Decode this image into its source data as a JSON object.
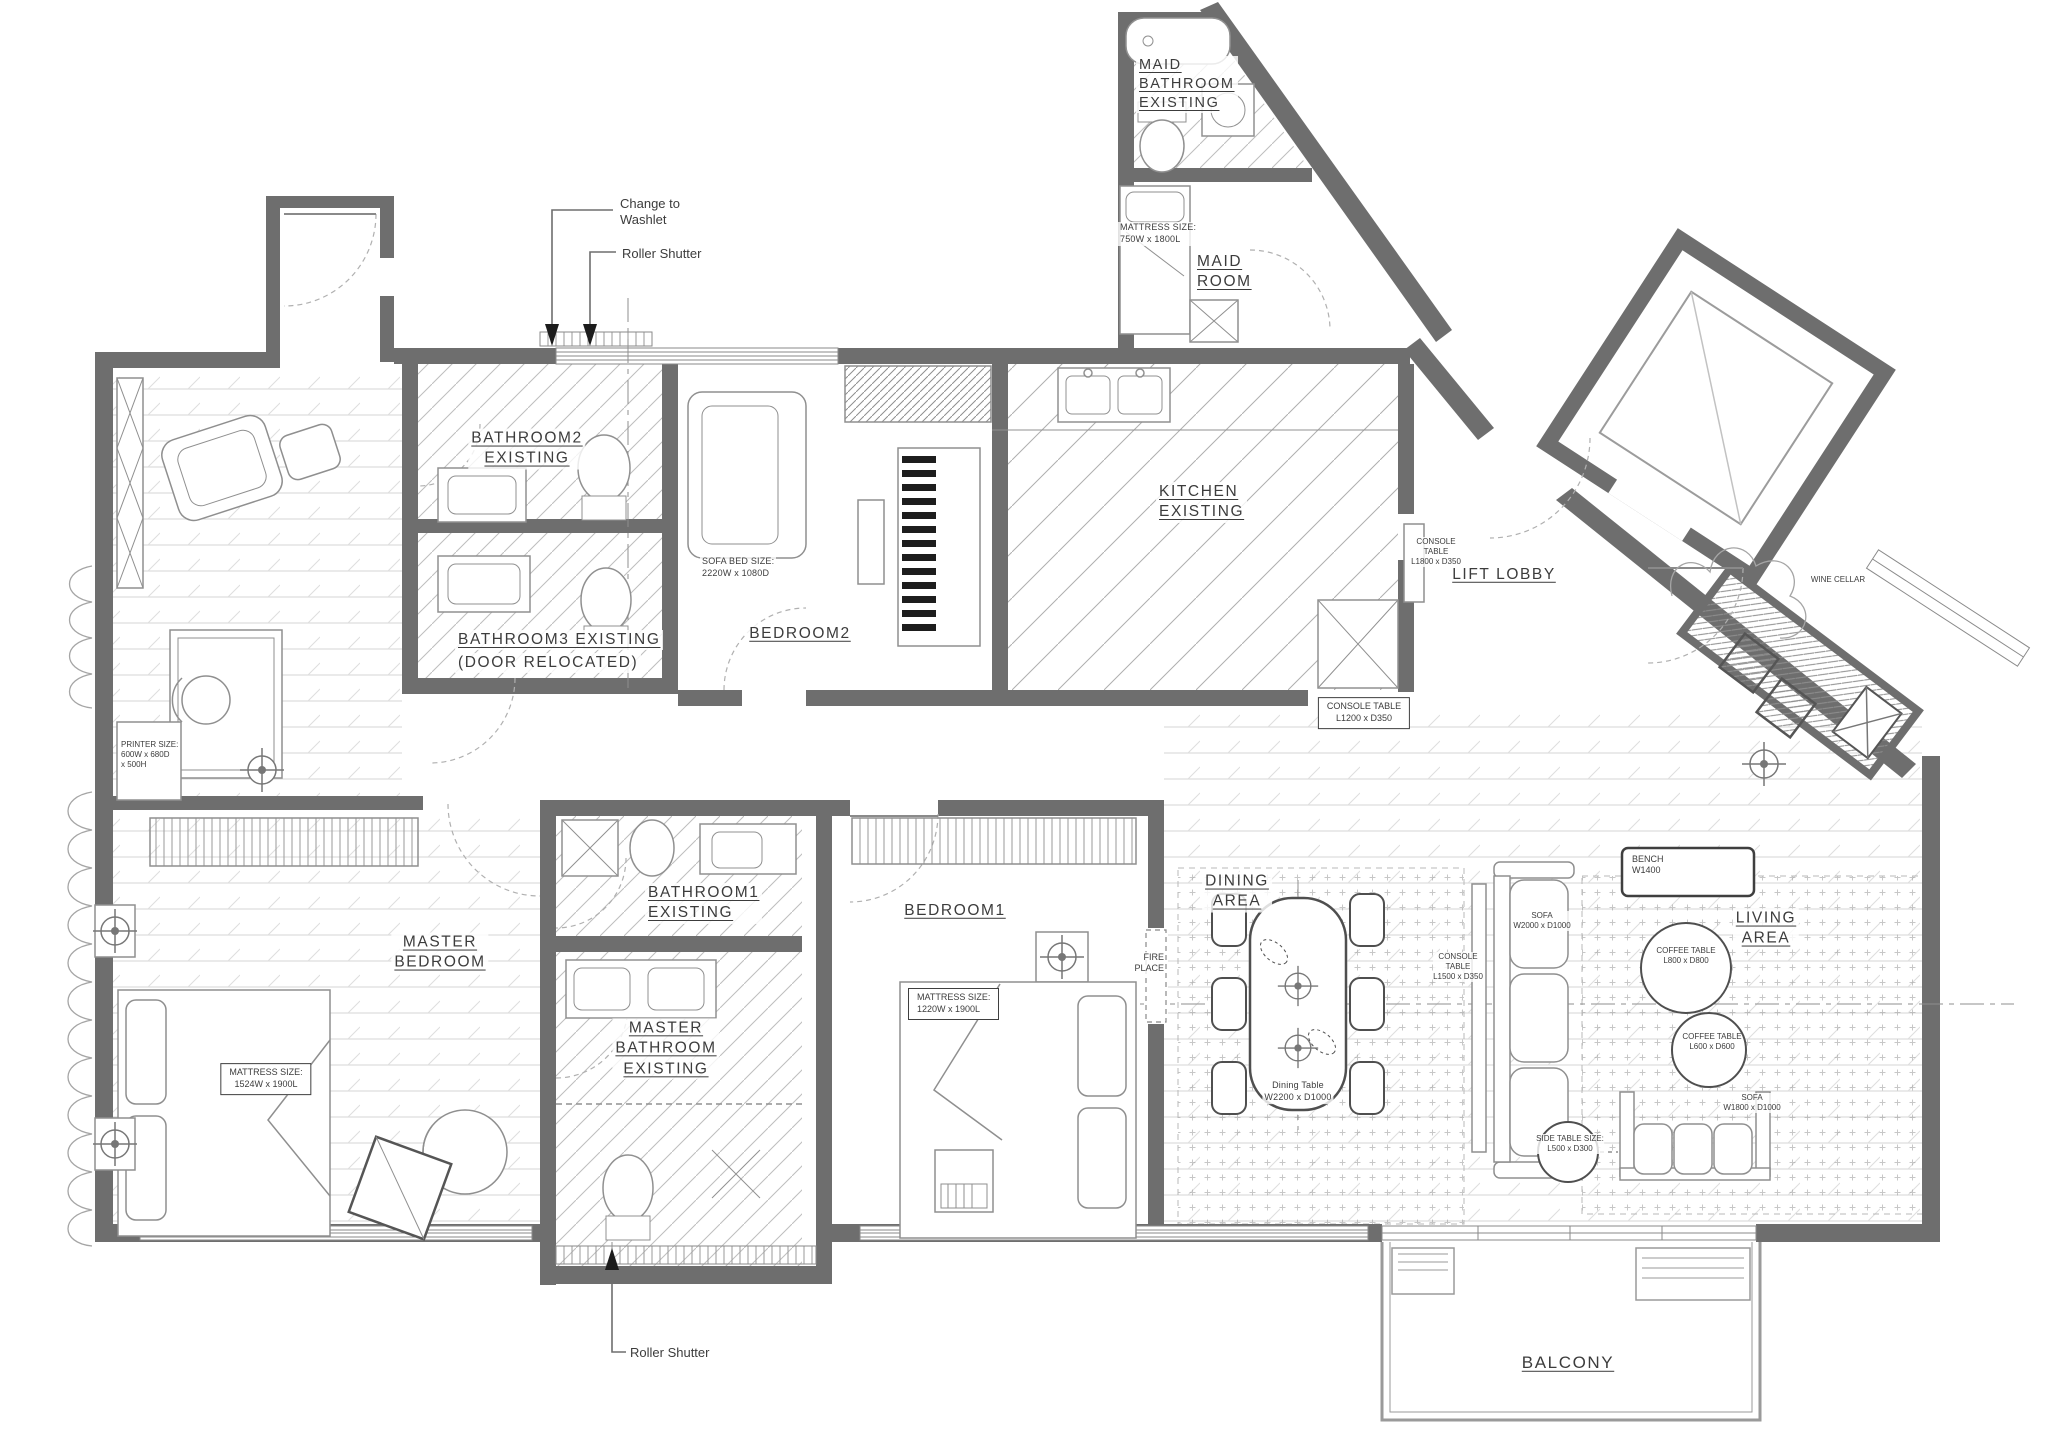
{
  "annotations": {
    "change_to_washlet": "Change to\nWashlet",
    "roller_shutter_top": "Roller Shutter",
    "roller_shutter_bottom": "Roller Shutter"
  },
  "rooms": {
    "bathroom2": "BATHROOM2\nEXISTING",
    "bathroom3_line1": "BATHROOM3 EXISTING",
    "bathroom3_line2": "(DOOR RELOCATED)",
    "bedroom2": "BEDROOM2",
    "maid_bathroom": "MAID\nBATHROOM\nEXISTING",
    "maid_room": "MAID\nROOM",
    "kitchen": "KITCHEN\nEXISTING",
    "lift_lobby": "LIFT LOBBY",
    "master_bedroom": "MASTER\nBEDROOM",
    "bathroom1": "BATHROOM1\nEXISTING",
    "master_bathroom": "MASTER\nBATHROOM\nEXISTING",
    "bedroom1": "BEDROOM1",
    "dining_area": "DINING\nAREA",
    "living_area": "LIVING\nAREA",
    "balcony": "BALCONY",
    "wine_cellar": "WINE CELLAR",
    "fire_place": "FIRE\nPLACE"
  },
  "furniture_notes": {
    "sofa_bed": "SOFA BED SIZE:\n2220W x 1080D",
    "maid_mattress": "MATTRESS SIZE:\n750W x 1800L",
    "console_1800": "CONSOLE\nTABLE\nL1800 x D350",
    "console_1200": "CONSOLE TABLE\nL1200 x D350",
    "console_1500": "CONSOLE\nTABLE\nL1500 x D350",
    "printer": "PRINTER SIZE:\n600W x 680D\nx 500H",
    "master_mattress": "MATTRESS SIZE:\n1524W x 1900L",
    "bedroom1_mattress": "MATTRESS SIZE:\n1220W x 1900L",
    "dining_table": "Dining Table\nW2200 x D1000",
    "bench": "BENCH\nW1400",
    "sofa_2000": "SOFA\nW2000 x D1000",
    "coffee_800": "COFFEE TABLE\nL800 x D800",
    "coffee_600": "COFFEE TABLE\nL600 x D600",
    "sofa_1800": "SOFA\nW1800 x D1000",
    "side_table": "SIDE TABLE SIZE:\nL500 x D300"
  },
  "colors": {
    "wall": "#6e6e6e",
    "line": "#8f8f8f",
    "hatch": "#b5b5b5",
    "text": "#3c3c3c"
  }
}
